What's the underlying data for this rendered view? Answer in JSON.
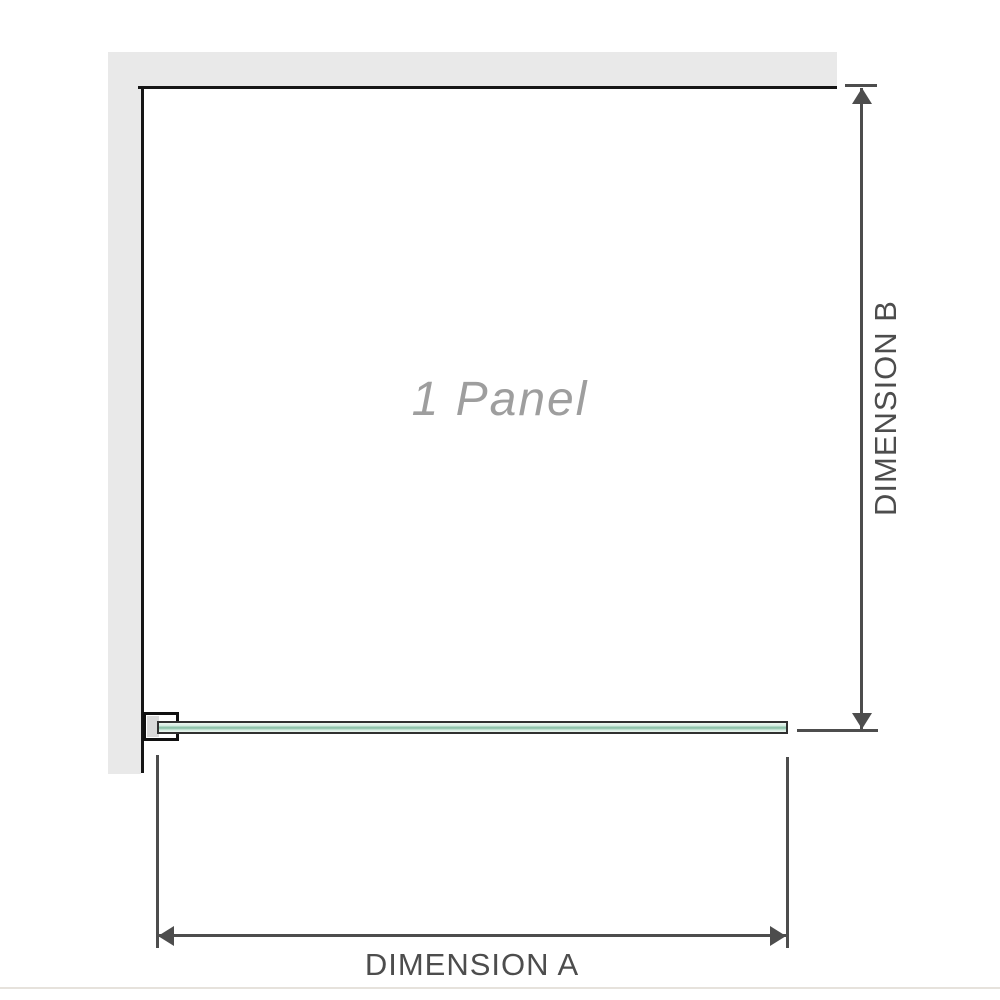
{
  "diagram": {
    "panel_label": "1 Panel",
    "dimension_a_label": "DIMENSION A",
    "dimension_b_label": "DIMENSION B"
  },
  "colors": {
    "wall_fill": "#e9e9e9",
    "wall_edge": "#161616",
    "dimension": "#4d4d4d",
    "panel_label_color": "#9e9e9e",
    "glass_outline": "#303030",
    "glass_light": "#d2ebdf",
    "glass_mid": "#8fc3ab",
    "glass_pale": "#eef7f1",
    "bracket_fill": "#d9d9d9",
    "baseline": "#e6e2dc"
  }
}
